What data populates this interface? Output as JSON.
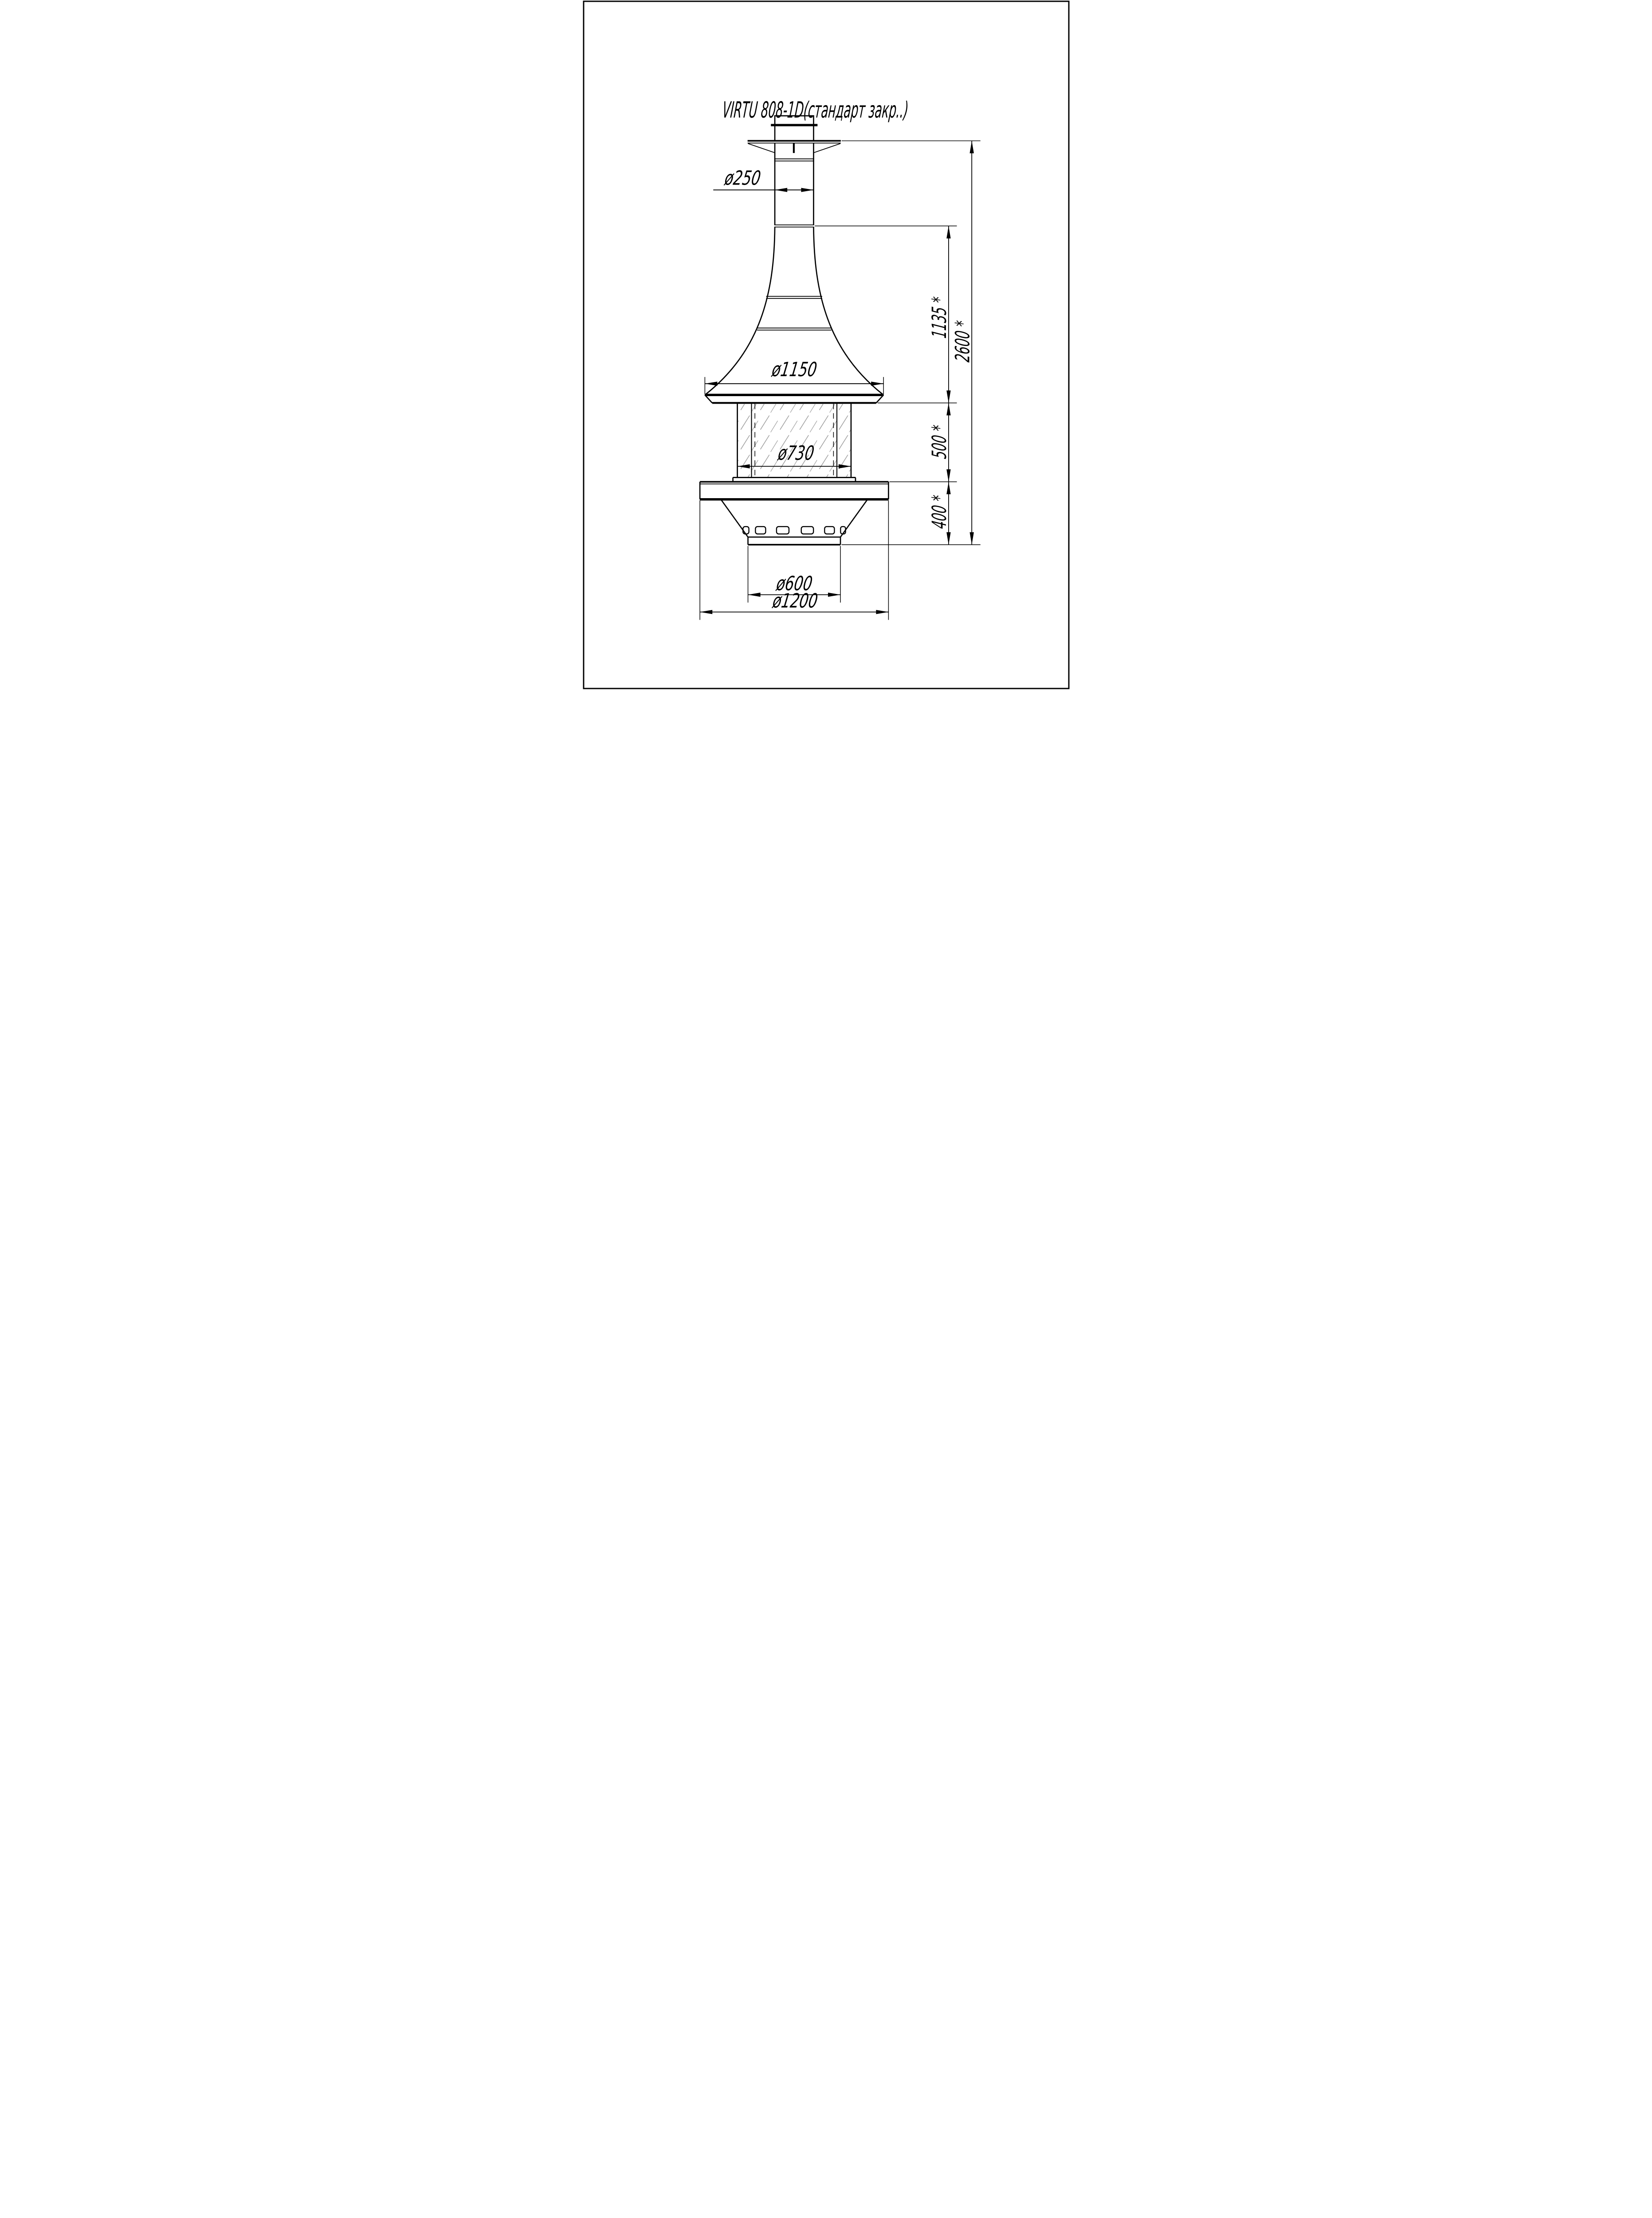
{
  "title": "VIRTU 808-1D(стандарт закр..)",
  "drawing": {
    "colors": {
      "line": "#000000",
      "hatch": "#9a9a9a",
      "background": "#ffffff"
    }
  },
  "dimensions": {
    "pipe_diameter": "ø250",
    "hood_diameter": "ø1150",
    "glass_diameter": "ø730",
    "outlet_diameter": "ø600",
    "base_diameter": "ø1200",
    "hood_height": "1135 *",
    "total_height": "2600 *",
    "glass_section_height": "500 *",
    "base_section_height": "400 *"
  }
}
